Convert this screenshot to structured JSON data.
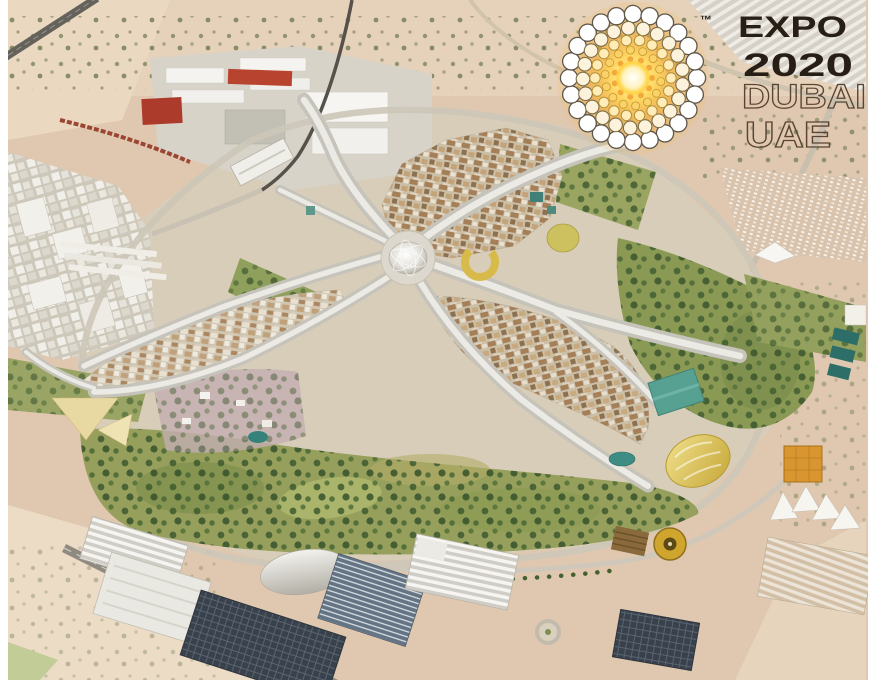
{
  "frame": {
    "bg": "#ffffff"
  },
  "logo": {
    "trademark": "™",
    "line1": "EXPO",
    "line2": "2020",
    "line3": "DUBAI",
    "line4": "UAE",
    "text_color": "#271f16",
    "outline_color": "#5a4534",
    "sun_core": "#ffd23e",
    "sun_glow": "#f3a62c"
  },
  "scene": {
    "description": "Aerial 3D rendering of the Expo 2020 Dubai site: central Al Wasl dome with white canopy boulevards radiating to three pavilion districts, ringed by green parks, roads, a metro line, warehouses, solar arrays and open desert.",
    "palette": {
      "desert_sand": "#e0c8b0",
      "site_ground": "#d8cdb8",
      "canopy": "#e9e7e0",
      "park_olive": "#96a05c",
      "roof_brown": "#a27c54",
      "solar_dark": "#39424c",
      "accent_red": "#b8432f",
      "accent_gold": "#cfa52e",
      "accent_yellow": "#d8ba4a",
      "accent_teal": "#3e8d85"
    }
  }
}
